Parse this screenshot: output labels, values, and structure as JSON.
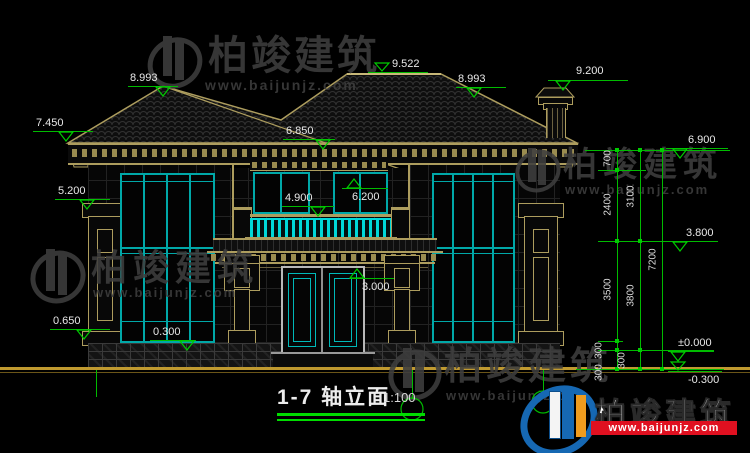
{
  "title": {
    "label": "1-7  轴立面",
    "scale": "1:100"
  },
  "watermark": {
    "brand": "柏竣建筑",
    "url": "www.baijunjz.com"
  },
  "colors": {
    "dim_green": "#00bb00",
    "trim_tan": "#ad9d5e",
    "window_cyan": "#00a8a8",
    "baluster_cyan": "#00d8d8",
    "text_white": "#e8e8e8",
    "ground_tan": "#c09a30",
    "logo_blue": "#1668b3",
    "logo_orange": "#f09c1e",
    "logo_red": "#e01020"
  },
  "drawing": {
    "elevation_markers": [
      {
        "label": "8.993",
        "lx": 128,
        "ly": 86,
        "lw": 50,
        "tx": 163,
        "style": "below",
        "tax": 130,
        "tay": 72
      },
      {
        "label": "9.522",
        "lx": 368,
        "ly": 72,
        "lw": 60,
        "tx": 382,
        "style": "hang",
        "tax": 392,
        "tay": 58
      },
      {
        "label": "8.993",
        "lx": 456,
        "ly": 87,
        "lw": 50,
        "tx": 474,
        "style": "below",
        "tax": 458,
        "tay": 73
      },
      {
        "label": "9.200",
        "lx": 548,
        "ly": 80,
        "lw": 80,
        "tx": 563,
        "style": "below",
        "tax": 576,
        "tay": 65
      },
      {
        "label": "7.450",
        "lx": 33,
        "ly": 131,
        "lw": 60,
        "tx": 66,
        "style": "below",
        "tax": 36,
        "tay": 117
      },
      {
        "label": "6.850",
        "lx": 283,
        "ly": 139,
        "lw": 52,
        "tx": 323,
        "style": "below",
        "tax": 286,
        "tay": 125
      },
      {
        "label": "6.900",
        "lx": 666,
        "ly": 148,
        "lw": 62,
        "tx": 680,
        "style": "below",
        "tax": 688,
        "tay": 134
      },
      {
        "label": "5.200",
        "lx": 55,
        "ly": 199,
        "lw": 55,
        "tx": 87,
        "style": "below",
        "tax": 58,
        "tay": 185
      },
      {
        "label": "6.200",
        "lx": 342,
        "ly": 188,
        "lw": 46,
        "tx": 354,
        "style": "apexup",
        "tax": 352,
        "tay": 191
      },
      {
        "label": "4.900",
        "lx": 282,
        "ly": 206,
        "lw": 52,
        "tx": 318,
        "style": "below",
        "tax": 285,
        "tay": 192
      },
      {
        "label": "3.800",
        "lx": 670,
        "ly": 241,
        "lw": 46,
        "tx": 680,
        "style": "below",
        "tax": 686,
        "tay": 227
      },
      {
        "label": "3.000",
        "lx": 350,
        "ly": 278,
        "lw": 44,
        "tx": 357,
        "style": "apexup",
        "tax": 362,
        "tay": 281
      },
      {
        "label": "0.650",
        "lx": 50,
        "ly": 329,
        "lw": 60,
        "tx": 84,
        "style": "below",
        "tax": 53,
        "tay": 315
      },
      {
        "label": "0.300",
        "lx": 150,
        "ly": 340,
        "lw": 46,
        "tx": 187,
        "style": "below",
        "tax": 153,
        "tay": 326
      },
      {
        "label": "±0.000",
        "lx": 668,
        "ly": 351,
        "lw": 46,
        "tx": 678,
        "style": "below",
        "tax": 678,
        "tay": 337
      },
      {
        "label": "-0.300",
        "lx": 668,
        "ly": 371,
        "lw": 54,
        "tx": 678,
        "style": "hang",
        "tax": 688,
        "tay": 374
      }
    ],
    "chains": {
      "lines": [
        [
          617,
          148,
          369
        ],
        [
          640,
          148,
          369
        ],
        [
          662,
          148,
          369
        ]
      ],
      "ext": [
        [
          150,
          585,
          730
        ],
        [
          170,
          598,
          646
        ],
        [
          241,
          598,
          718
        ],
        [
          341,
          598,
          623
        ],
        [
          350,
          598,
          714
        ],
        [
          369,
          576,
          724
        ]
      ],
      "ticks": [
        [
          617,
          150
        ],
        [
          617,
          170
        ],
        [
          617,
          241
        ],
        [
          617,
          341
        ],
        [
          617,
          350
        ],
        [
          617,
          369
        ],
        [
          640,
          150
        ],
        [
          640,
          241
        ],
        [
          640,
          350
        ],
        [
          640,
          369
        ],
        [
          662,
          150
        ],
        [
          662,
          369
        ]
      ],
      "labels": [
        {
          "text": "700",
          "x": 608,
          "y": 160
        },
        {
          "text": "2400",
          "x": 608,
          "y": 206
        },
        {
          "text": "3500",
          "x": 608,
          "y": 291
        },
        {
          "text": "300",
          "x": 599,
          "y": 352
        },
        {
          "text": "300",
          "x": 599,
          "y": 374
        },
        {
          "text": "3100",
          "x": 631,
          "y": 198
        },
        {
          "text": "3800",
          "x": 631,
          "y": 297
        },
        {
          "text": "300",
          "x": 622,
          "y": 362
        },
        {
          "text": "7200",
          "x": 653,
          "y": 261
        }
      ]
    },
    "axis": {
      "circles": [
        [
          412,
          409
        ],
        [
          543,
          402
        ]
      ],
      "stubs": [
        [
          96,
          370,
          397
        ],
        [
          412,
          370,
          399
        ],
        [
          543,
          370,
          392
        ]
      ]
    }
  }
}
